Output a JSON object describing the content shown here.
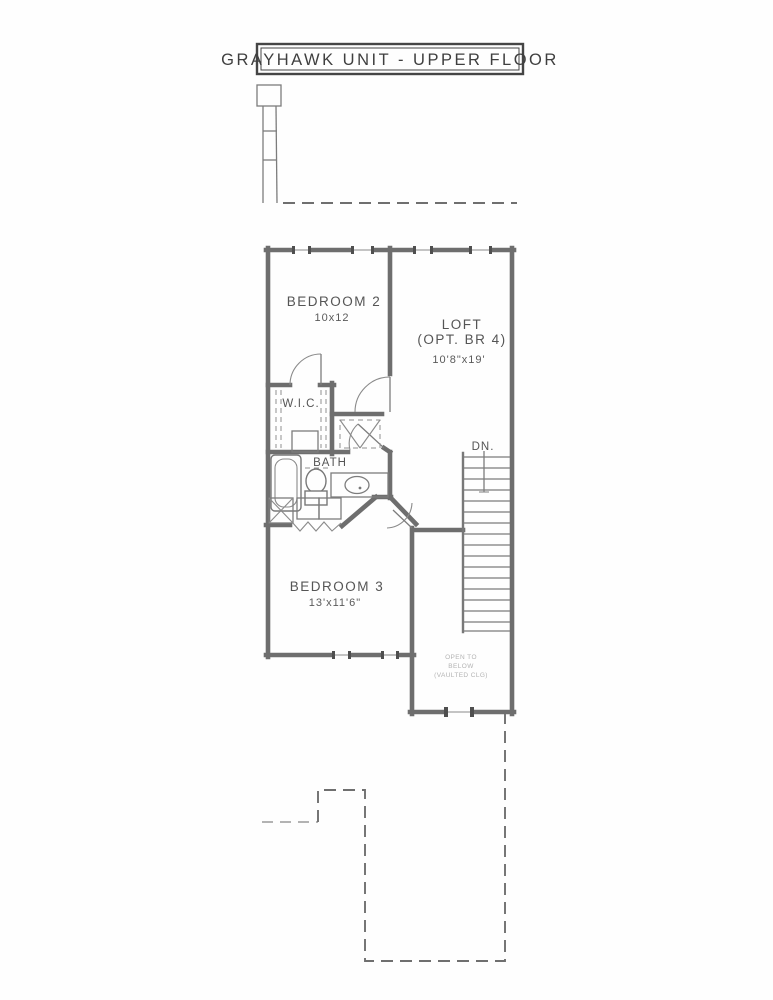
{
  "document": {
    "title": "GRAYHAWK UNIT  - UPPER FLOOR"
  },
  "rooms": {
    "bedroom2": {
      "name": "BEDROOM 2",
      "dims": "10x12"
    },
    "loft": {
      "name": "LOFT",
      "opt": "(OPT. BR 4)",
      "dims": "10'8\"x19'"
    },
    "wic": {
      "name": "W.I.C."
    },
    "bath": {
      "name": "BATH"
    },
    "bedroom3": {
      "name": "BEDROOM 3",
      "dims": "13'x11'6\""
    }
  },
  "stairs": {
    "label": "DN."
  },
  "notes": {
    "open_below_line1": "OPEN TO",
    "open_below_line2": "BELOW",
    "open_below_line3": "(VAULTED CLG)"
  },
  "colors": {
    "wall": "#6e6e6e",
    "thin_line": "#7c7c7c",
    "text": "#555555",
    "faint_text": "#b3b3b3",
    "background": "#fefefe"
  }
}
